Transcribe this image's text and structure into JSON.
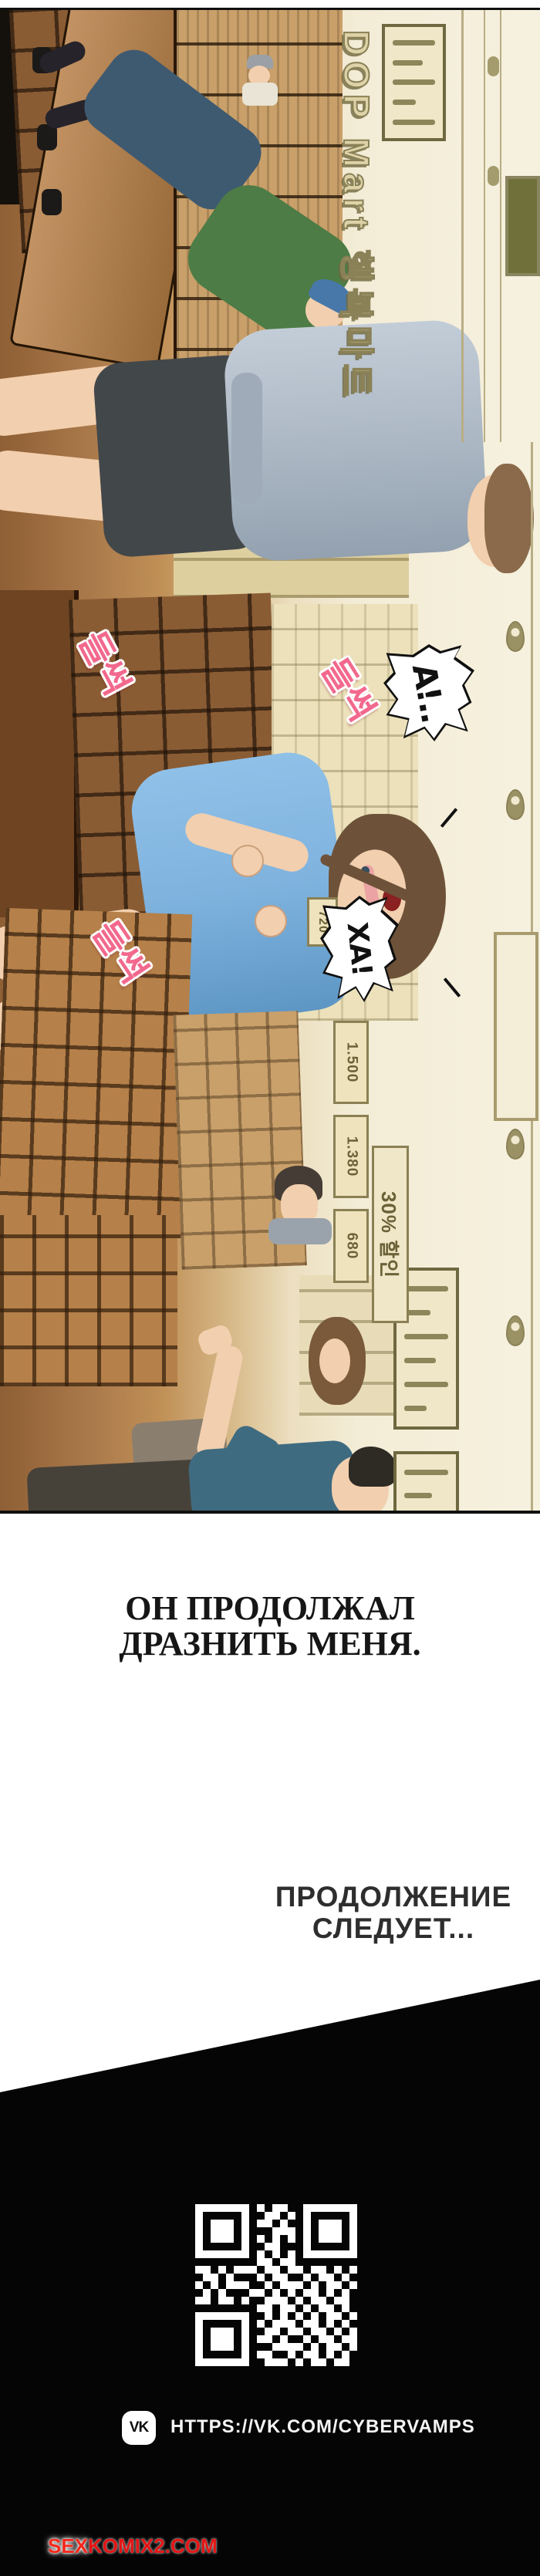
{
  "panel": {
    "store_sign": "DOP Mart 행복마트",
    "sfx": [
      "들썩",
      "들썩",
      "들썩"
    ],
    "bubble_a": "А!..",
    "bubble_ha": "ХА!",
    "price_tags": [
      "720",
      "1.500",
      "1.380",
      "680"
    ],
    "discount": "30% 할인"
  },
  "captions": {
    "narration1": "ОН ПРОДОЛЖАЛ",
    "narration2": "ДРАЗНИТЬ МЕНЯ.",
    "continued1": "ПРОДОЛЖЕНИЕ",
    "continued2": "СЛЕДУЕТ..."
  },
  "footer": {
    "vk_label": "VK",
    "url": "HTTPS://VK.COM/CYBERVAMPS",
    "watermark_prefix": "SEX",
    "watermark_suffix": "KOMIX2.COM",
    "qr_rows": [
      "111111101011001111111",
      "100000100110101000001",
      "101110101101001011101",
      "101110100011101011101",
      "101110101010101011101",
      "100000100110001000001",
      "111111101010101111111",
      "000000001101100000000",
      "110101110110110110101",
      "011010001011001011010",
      "101011100101110101101",
      "010100011010101101010",
      "110110100111010110110",
      "000000001101101011010",
      "111111100101010101101",
      "100000101011101101010",
      "101110100110110110101",
      "101110101101001011011",
      "101110100011110101101",
      "100000101100101101010",
      "111111100111010110110"
    ]
  },
  "colors": {
    "accent_pink": "#f2698d",
    "watermark_red": "#e41414",
    "panel_cream": "#f3ecd6",
    "panel_brown": "#9a6b3e",
    "sign_olive": "#8a8157",
    "footer_black": "#050505"
  }
}
